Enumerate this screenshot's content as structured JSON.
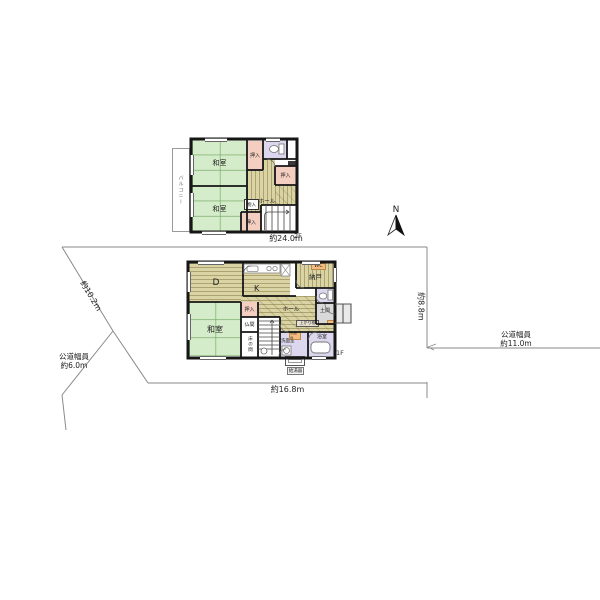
{
  "site": {
    "compass_label": "N",
    "dim_top": "約24.0m",
    "dim_right": "約8.8m",
    "dim_bottom": "約16.8m",
    "dim_left_diagonal": "約10.2m",
    "road_left_line1": "公道幅員",
    "road_left_line2": "約6.0m",
    "road_right_line1": "公道幅員",
    "road_right_line2": "約11.0m"
  },
  "floor2": {
    "floor_label": "2F",
    "balcony": "バルコニー",
    "washitsu_top": "和室",
    "washitsu_bottom": "和室",
    "closet_top": "押入",
    "closet_right": "押入",
    "closet_bottom": "押入",
    "storage_small": "物入",
    "hall": "ホール"
  },
  "floor1": {
    "floor_label": "1F",
    "dining": "D",
    "kitchen": "K",
    "cupboard": "カップボード",
    "wc": "WC",
    "storage_room": "納戸",
    "hall": "ホール",
    "washitsu": "和室",
    "closet": "押入",
    "butsuma": "仏間",
    "tokonoma": "床の間",
    "washroom": "洗面室",
    "washstand": "洗面台",
    "bathroom": "浴室",
    "doma": "土間",
    "agari_kamachi": "上がり框",
    "water_heater": "給湯器"
  },
  "colors": {
    "tatami_green": "#d5ecca",
    "wood_floor": "#dad3a4",
    "closet_pink": "#f4cfc1",
    "sanitary_lavender": "#dcd7ee",
    "doma_gray": "#d9d9d9",
    "wc_orange": "#f2bd7e",
    "wall": "#161616",
    "boundary_line": "#8a8a8a"
  }
}
